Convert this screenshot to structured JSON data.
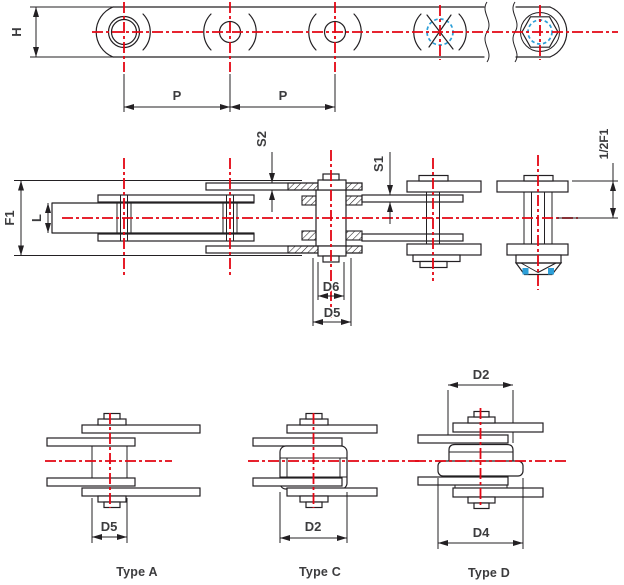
{
  "colors": {
    "ink": "#232023",
    "red": "#e30613",
    "blue": "#2d9fd8",
    "text": "#3c3c3e"
  },
  "top_view": {
    "height_label": "H",
    "pitch_label_1": "P",
    "pitch_label_2": "P"
  },
  "plan_view": {
    "overall_width_label": "F1",
    "inner_width_label": "L",
    "outer_plate_thickness_label": "S2",
    "inner_plate_thickness_label": "S1",
    "half_width_label": "1/2F1",
    "hub_diameter_label": "D6",
    "roller_diameter_label": "D5"
  },
  "sections": {
    "a": {
      "title": "Type A",
      "roller_diameter_label": "D5"
    },
    "c": {
      "title": "Type C",
      "flange_diameter_label": "D2"
    },
    "d": {
      "title": "Type D",
      "flange_diameter_label": "D2",
      "large_flange_diameter_label": "D4"
    }
  }
}
